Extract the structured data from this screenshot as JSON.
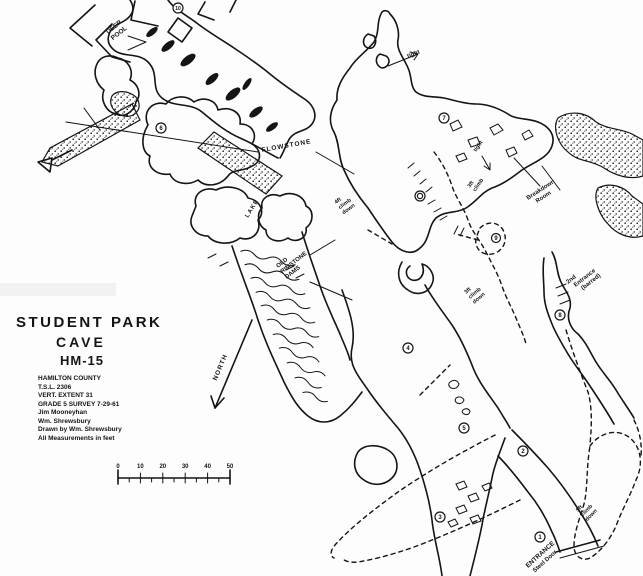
{
  "title_block": {
    "line1": "STUDENT PARK",
    "line2": "CAVE",
    "line3": "HM-15",
    "county": "HAMILTON COUNTY",
    "tsl": "T.S.L. 2306",
    "vert_extent": "VERT. EXTENT 31",
    "grade_survey": "GRADE 5 SURVEY 7-29-61",
    "surveyor1": "Jim Mooneyhan",
    "surveyor2": "Wm. Shrewsbury",
    "drawn_by": "Drawn by Wm. Shrewsbury",
    "units_note": "All Measurements in feet"
  },
  "north_arrow": {
    "label": "NORTH"
  },
  "scale_bar": {
    "ticks": [
      "0",
      "10",
      "20",
      "30",
      "40",
      "50"
    ],
    "units": "feet"
  },
  "map_labels": {
    "deep_pool": {
      "l1": "DEEP",
      "l2": "POOL"
    },
    "tight_top": {
      "l1": "tight"
    },
    "flowstone": {
      "l1": "FLOWSTONE"
    },
    "lake": {
      "l1": "LAKE"
    },
    "old_rimstone_dams": {
      "l1": "OLD",
      "l2": "RIMSTONE",
      "l3": "DAMS"
    },
    "climb_4ft": {
      "l1": "4ft",
      "l2": "climb",
      "l3": "down"
    },
    "tight_right": {
      "l1": "tight"
    },
    "climb_3ft_right": {
      "l1": "3ft",
      "l2": "climb"
    },
    "breakdown_room": {
      "l1": "Breakdown",
      "l2": "Room"
    },
    "climb_3ft_center": {
      "l1": "3ft",
      "l2": "climb",
      "l3": "down"
    },
    "second_entrance": {
      "l1": "2nd",
      "l2": "Entrance",
      "l3": "(barred)"
    },
    "climb_5ft": {
      "l1": "5ft",
      "l2": "climb",
      "l3": "down"
    },
    "entrance": {
      "l1": "ENTRANCE",
      "l2": "Steel Door"
    }
  },
  "stations": {
    "s1": "1",
    "s2": "2",
    "s3": "3",
    "s4": "4",
    "s5": "5",
    "s6": "6",
    "s7": "7",
    "s8": "8",
    "s9": "9",
    "s10": "10",
    "s_dot": "●"
  },
  "colors": {
    "ink": "#141414",
    "paper": "#fdfdfd"
  }
}
